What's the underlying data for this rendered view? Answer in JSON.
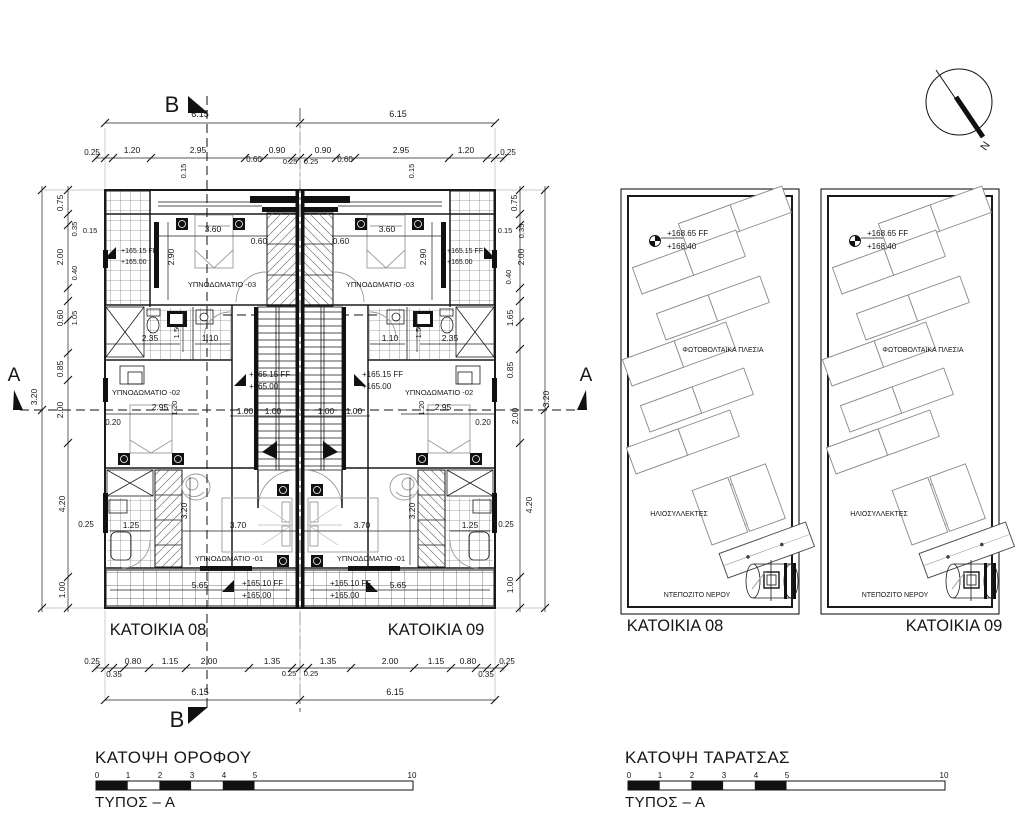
{
  "page": {
    "background": "#ffffff",
    "ink": "#1a1a1a"
  },
  "north": {
    "label": "N"
  },
  "floor_plan": {
    "title": "ΚΑΤΟΨΗ ΟΡΟΦΟΥ",
    "type_label": "ΤΥΠΟΣ – Α",
    "units": [
      {
        "name": "ΚΑΤΟΙΚΙΑ 08"
      },
      {
        "name": "ΚΑΤΟΙΚΙΑ 09"
      }
    ],
    "rooms": [
      "ΥΠΝΟΔΩΜΑΤΙΟ -01",
      "ΥΠΝΟΔΩΜΑΤΙΟ -02",
      "ΥΠΝΟΔΩΜΑΤΙΟ -03"
    ],
    "levels": [
      "+165.15 FF",
      "+165.10 FF",
      "+165.00"
    ],
    "section_marks": [
      "A",
      "B"
    ]
  },
  "roof_plan": {
    "title": "ΚΑΤΟΨΗ ΤΑΡΑΤΣΑΣ",
    "type_label": "ΤΥΠΟΣ – Α",
    "units": [
      {
        "name": "ΚΑΤΟΙΚΙΑ 08"
      },
      {
        "name": "ΚΑΤΟΙΚΙΑ 09"
      }
    ],
    "features": [
      "ΦΩΤΟΒΟΛΤΑΪΚΑ ΠΛΕΣΙΑ",
      "ΗΛΙΟΣΥΛΛΕΚΤΕΣ",
      "ΝΤΕΠΟΖΙΤΟ ΝΕΡΟΥ"
    ],
    "levels": [
      "+168.65 FF",
      "+168,40"
    ]
  },
  "scale_bar": {
    "numbers": [
      "0",
      "1",
      "2",
      "3",
      "4",
      "5",
      "10"
    ]
  },
  "labels": [
    {
      "t": "6.15",
      "x": 200,
      "y": 117,
      "s": 9
    },
    {
      "t": "6.15",
      "x": 398,
      "y": 117,
      "s": 9
    },
    {
      "t": "0.25",
      "x": 92,
      "y": 155,
      "s": 8
    },
    {
      "t": "1.20",
      "x": 132,
      "y": 153
    },
    {
      "t": "2.95",
      "x": 198,
      "y": 153
    },
    {
      "t": "0.60",
      "x": 254,
      "y": 162,
      "s": 8
    },
    {
      "t": "0.90",
      "x": 277,
      "y": 153
    },
    {
      "t": "0.25",
      "x": 290,
      "y": 164,
      "s": 7.5
    },
    {
      "t": "0.25",
      "x": 311,
      "y": 164,
      "s": 7.5
    },
    {
      "t": "0.90",
      "x": 323,
      "y": 153
    },
    {
      "t": "0.60",
      "x": 345,
      "y": 162,
      "s": 8
    },
    {
      "t": "2.95",
      "x": 401,
      "y": 153
    },
    {
      "t": "1.20",
      "x": 466,
      "y": 153
    },
    {
      "t": "0.25",
      "x": 508,
      "y": 155,
      "s": 8
    },
    {
      "t": "0.15",
      "x": 186,
      "y": 171,
      "r": -90,
      "s": 7.5
    },
    {
      "t": "0.15",
      "x": 414,
      "y": 171,
      "r": -90,
      "s": 7.5
    },
    {
      "t": "0.75",
      "x": 63,
      "y": 203,
      "r": -90
    },
    {
      "t": "0.35",
      "x": 77,
      "y": 229,
      "r": -90,
      "s": 7.5
    },
    {
      "t": "0.15",
      "x": 90,
      "y": 233,
      "s": 7.5
    },
    {
      "t": "2.00",
      "x": 63,
      "y": 257,
      "r": -90
    },
    {
      "t": "0.40",
      "x": 77,
      "y": 273,
      "r": -90,
      "s": 7.5
    },
    {
      "t": "0.60",
      "x": 63,
      "y": 318,
      "r": -90
    },
    {
      "t": "1.05",
      "x": 77,
      "y": 318,
      "r": -90,
      "s": 7.5
    },
    {
      "t": "0.85",
      "x": 63,
      "y": 369,
      "r": -90
    },
    {
      "t": "3.20",
      "x": 37,
      "y": 397,
      "r": -90
    },
    {
      "t": "2.00",
      "x": 63,
      "y": 410,
      "r": -90
    },
    {
      "t": "4.20",
      "x": 65,
      "y": 504,
      "r": -90
    },
    {
      "t": "1.00",
      "x": 65,
      "y": 590,
      "r": -90
    },
    {
      "t": "0.25",
      "x": 86,
      "y": 527,
      "s": 8
    },
    {
      "t": "0.75",
      "x": 517,
      "y": 203,
      "r": -90
    },
    {
      "t": "0.35",
      "x": 524,
      "y": 231,
      "r": -90,
      "s": 7.5
    },
    {
      "t": "0.15",
      "x": 505,
      "y": 233,
      "s": 7.5
    },
    {
      "t": "2.00",
      "x": 524,
      "y": 257,
      "r": -90
    },
    {
      "t": "0.40",
      "x": 511,
      "y": 277,
      "r": -90,
      "s": 7.5
    },
    {
      "t": "1.65",
      "x": 513,
      "y": 318,
      "r": -90
    },
    {
      "t": "0.85",
      "x": 513,
      "y": 370,
      "r": -90
    },
    {
      "t": "3.20",
      "x": 549,
      "y": 399,
      "r": -90
    },
    {
      "t": "2.00",
      "x": 518,
      "y": 416,
      "r": -90
    },
    {
      "t": "4.20",
      "x": 532,
      "y": 505,
      "r": -90
    },
    {
      "t": "1.00",
      "x": 513,
      "y": 585,
      "r": -90
    },
    {
      "t": "0.25",
      "x": 506,
      "y": 527,
      "s": 8
    },
    {
      "t": "3.60",
      "x": 213,
      "y": 232
    },
    {
      "t": "3.60",
      "x": 387,
      "y": 232
    },
    {
      "t": "0.60",
      "x": 259,
      "y": 244
    },
    {
      "t": "0.60",
      "x": 341,
      "y": 244
    },
    {
      "t": "2.90",
      "x": 174,
      "y": 257,
      "r": -90
    },
    {
      "t": "2.90",
      "x": 426,
      "y": 257,
      "r": -90
    },
    {
      "t": "+165.15 FF",
      "x": 121,
      "y": 253,
      "s": 7,
      "a": "start"
    },
    {
      "t": "+165.00",
      "x": 121,
      "y": 264,
      "s": 7,
      "a": "start"
    },
    {
      "t": "+165.15 FF",
      "x": 447,
      "y": 253,
      "s": 7,
      "a": "start"
    },
    {
      "t": "+165.00",
      "x": 447,
      "y": 264,
      "s": 7,
      "a": "start"
    },
    {
      "t": "ΥΠΝΟΔΩΜΑΤΙΟ -03",
      "x": 222,
      "y": 287,
      "s": 7.5
    },
    {
      "t": "ΥΠΝΟΔΩΜΑΤΙΟ -03",
      "x": 380,
      "y": 287,
      "s": 7.5
    },
    {
      "t": "2.35",
      "x": 150,
      "y": 341
    },
    {
      "t": "2.35",
      "x": 450,
      "y": 341
    },
    {
      "t": "1.50",
      "x": 179,
      "y": 331,
      "r": -90,
      "s": 7.5
    },
    {
      "t": "1.50",
      "x": 421,
      "y": 331,
      "r": -90,
      "s": 7.5
    },
    {
      "t": "1.10",
      "x": 210,
      "y": 341
    },
    {
      "t": "1.10",
      "x": 390,
      "y": 341
    },
    {
      "t": "+165.15 FF",
      "x": 249,
      "y": 377,
      "s": 8,
      "a": "start"
    },
    {
      "t": "+165.00",
      "x": 249,
      "y": 389,
      "s": 8,
      "a": "start"
    },
    {
      "t": "+165.15 FF",
      "x": 362,
      "y": 377,
      "s": 8,
      "a": "start"
    },
    {
      "t": "+165.00",
      "x": 362,
      "y": 389,
      "s": 8,
      "a": "start"
    },
    {
      "t": "ΥΠΝΟΔΩΜΑΤΙΟ -02",
      "x": 146,
      "y": 395,
      "s": 7.5
    },
    {
      "t": "ΥΠΝΟΔΩΜΑΤΙΟ -02",
      "x": 439,
      "y": 395,
      "s": 7.5
    },
    {
      "t": "2.95",
      "x": 160,
      "y": 410
    },
    {
      "t": "2.95",
      "x": 443,
      "y": 410
    },
    {
      "t": "1.20",
      "x": 177,
      "y": 408,
      "r": -90,
      "s": 7.5
    },
    {
      "t": "1.20",
      "x": 424,
      "y": 408,
      "r": -90,
      "s": 7.5
    },
    {
      "t": "0.20",
      "x": 113,
      "y": 425,
      "s": 8
    },
    {
      "t": "0.20",
      "x": 483,
      "y": 425,
      "s": 8
    },
    {
      "t": "1.00",
      "x": 245,
      "y": 414
    },
    {
      "t": "1.00",
      "x": 273,
      "y": 414
    },
    {
      "t": "1.00",
      "x": 326,
      "y": 414
    },
    {
      "t": "1.00",
      "x": 354,
      "y": 414
    },
    {
      "t": "3.20",
      "x": 187,
      "y": 511,
      "r": -90
    },
    {
      "t": "3.20",
      "x": 415,
      "y": 511,
      "r": -90
    },
    {
      "t": "3.70",
      "x": 238,
      "y": 528
    },
    {
      "t": "3.70",
      "x": 362,
      "y": 528
    },
    {
      "t": "1.25",
      "x": 131,
      "y": 528
    },
    {
      "t": "1.25",
      "x": 470,
      "y": 528
    },
    {
      "t": "ΥΠΝΟΔΩΜΑΤΙΟ -01",
      "x": 229,
      "y": 561,
      "s": 7.5
    },
    {
      "t": "ΥΠΝΟΔΩΜΑΤΙΟ -01",
      "x": 371,
      "y": 561,
      "s": 7.5
    },
    {
      "t": "5.65",
      "x": 200,
      "y": 588
    },
    {
      "t": "5.65",
      "x": 398,
      "y": 588
    },
    {
      "t": "+165.10 FF",
      "x": 242,
      "y": 586,
      "s": 8,
      "a": "start"
    },
    {
      "t": "+165.00",
      "x": 242,
      "y": 598,
      "s": 8,
      "a": "start"
    },
    {
      "t": "+165.10 FF",
      "x": 330,
      "y": 586,
      "s": 8,
      "a": "start"
    },
    {
      "t": "+165.00",
      "x": 330,
      "y": 598,
      "s": 8,
      "a": "start"
    },
    {
      "t": "0.25",
      "x": 92,
      "y": 664,
      "s": 8
    },
    {
      "t": "0.35",
      "x": 114,
      "y": 677,
      "s": 8
    },
    {
      "t": "0.80",
      "x": 133,
      "y": 664
    },
    {
      "t": "1.15",
      "x": 170,
      "y": 664
    },
    {
      "t": "2.00",
      "x": 209,
      "y": 664
    },
    {
      "t": "1.35",
      "x": 272,
      "y": 664
    },
    {
      "t": "0.25",
      "x": 289,
      "y": 676,
      "s": 7.5
    },
    {
      "t": "0.25",
      "x": 311,
      "y": 676,
      "s": 7.5
    },
    {
      "t": "1.35",
      "x": 328,
      "y": 664
    },
    {
      "t": "2.00",
      "x": 390,
      "y": 664
    },
    {
      "t": "1.15",
      "x": 436,
      "y": 664
    },
    {
      "t": "0.80",
      "x": 468,
      "y": 664
    },
    {
      "t": "0.35",
      "x": 486,
      "y": 677,
      "s": 8
    },
    {
      "t": "0.25",
      "x": 507,
      "y": 664,
      "s": 8
    },
    {
      "t": "6.15",
      "x": 200,
      "y": 695,
      "s": 9
    },
    {
      "t": "6.15",
      "x": 395,
      "y": 695,
      "s": 9
    },
    {
      "t": "B",
      "x": 172,
      "y": 112,
      "s": 22,
      "n": "section-mark-b-top"
    },
    {
      "t": "B",
      "x": 177,
      "y": 727,
      "s": 22,
      "n": "section-mark-b-bottom"
    },
    {
      "t": "A",
      "x": 14,
      "y": 381,
      "s": 19,
      "n": "section-mark-a-left"
    },
    {
      "t": "A",
      "x": 586,
      "y": 381,
      "s": 19,
      "n": "section-mark-a-right"
    },
    {
      "t": "N",
      "x": 988,
      "y": 148,
      "s": 11,
      "r": -55,
      "n": "north-letter"
    },
    {
      "t": "ΚΑΤΟΙΚΙΑ 08",
      "x": 158,
      "y": 635,
      "s": 16.5,
      "n": "unit-title"
    },
    {
      "t": "ΚΑΤΟΙΚΙΑ 09",
      "x": 436,
      "y": 635,
      "s": 16.5,
      "n": "unit-title"
    },
    {
      "t": "ΚΑΤΟΙΚΙΑ 08",
      "x": 675,
      "y": 631,
      "s": 16.5,
      "n": "unit-title"
    },
    {
      "t": "ΚΑΤΟΙΚΙΑ 09",
      "x": 954,
      "y": 631,
      "s": 16.5,
      "n": "unit-title"
    },
    {
      "t": "+168.65 FF",
      "x": 667,
      "y": 236,
      "s": 8,
      "a": "start"
    },
    {
      "t": "+168,40",
      "x": 667,
      "y": 249,
      "s": 8,
      "a": "start"
    },
    {
      "t": "+168.65 FF",
      "x": 867,
      "y": 236,
      "s": 8,
      "a": "start"
    },
    {
      "t": "+168,40",
      "x": 867,
      "y": 249,
      "s": 8,
      "a": "start"
    },
    {
      "t": "ΦΩΤΟΒΟΛΤΑΪΚΑ ΠΛΕΣΙΑ",
      "x": 723,
      "y": 352,
      "s": 7,
      "n": "pv-label"
    },
    {
      "t": "ΦΩΤΟΒΟΛΤΑΪΚΑ ΠΛΕΣΙΑ",
      "x": 923,
      "y": 352,
      "s": 7,
      "n": "pv-label"
    },
    {
      "t": "ΗΛΙΟΣΥΛΛΕΚΤΕΣ",
      "x": 679,
      "y": 516,
      "s": 7,
      "n": "collector-label"
    },
    {
      "t": "ΗΛΙΟΣΥΛΛΕΚΤΕΣ",
      "x": 879,
      "y": 516,
      "s": 7,
      "n": "collector-label"
    },
    {
      "t": "ΝΤΕΠΟΖΙΤΟ ΝΕΡΟΥ",
      "x": 697,
      "y": 597,
      "s": 7,
      "n": "tank-label"
    },
    {
      "t": "ΝΤΕΠΟΖΙΤΟ ΝΕΡΟΥ",
      "x": 895,
      "y": 597,
      "s": 7,
      "n": "tank-label"
    },
    {
      "t": "0",
      "x": 97,
      "y": 778,
      "s": 8,
      "n": "scale-number"
    },
    {
      "t": "1",
      "x": 128,
      "y": 778,
      "s": 8,
      "n": "scale-number"
    },
    {
      "t": "2",
      "x": 160,
      "y": 778,
      "s": 8,
      "n": "scale-number"
    },
    {
      "t": "3",
      "x": 192,
      "y": 778,
      "s": 8,
      "n": "scale-number"
    },
    {
      "t": "4",
      "x": 224,
      "y": 778,
      "s": 8,
      "n": "scale-number"
    },
    {
      "t": "5",
      "x": 255,
      "y": 778,
      "s": 8,
      "n": "scale-number"
    },
    {
      "t": "10",
      "x": 412,
      "y": 778,
      "s": 8,
      "n": "scale-number"
    },
    {
      "t": "0",
      "x": 629,
      "y": 778,
      "s": 8,
      "n": "scale-number"
    },
    {
      "t": "1",
      "x": 660,
      "y": 778,
      "s": 8,
      "n": "scale-number"
    },
    {
      "t": "2",
      "x": 692,
      "y": 778,
      "s": 8,
      "n": "scale-number"
    },
    {
      "t": "3",
      "x": 724,
      "y": 778,
      "s": 8,
      "n": "scale-number"
    },
    {
      "t": "4",
      "x": 756,
      "y": 778,
      "s": 8,
      "n": "scale-number"
    },
    {
      "t": "5",
      "x": 787,
      "y": 778,
      "s": 8,
      "n": "scale-number"
    },
    {
      "t": "10",
      "x": 944,
      "y": 778,
      "s": 8,
      "n": "scale-number"
    }
  ]
}
